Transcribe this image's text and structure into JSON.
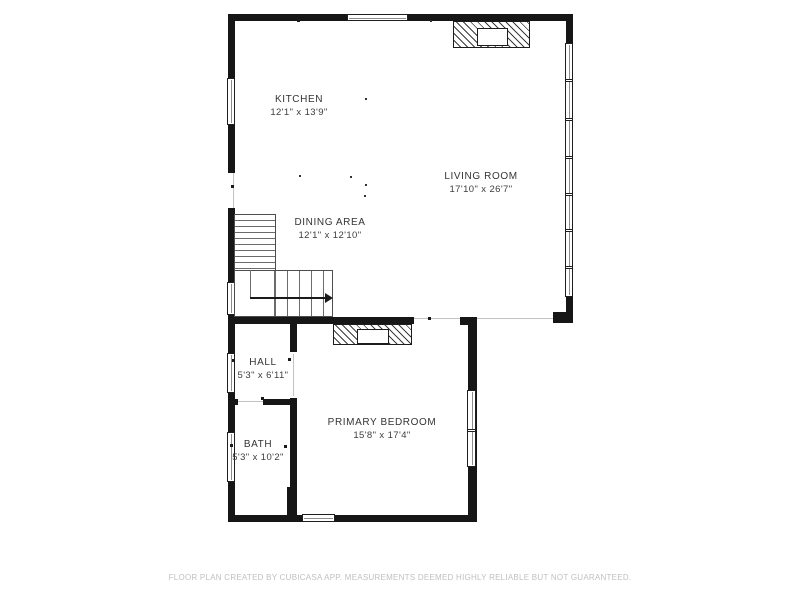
{
  "plan": {
    "type": "floor-plan",
    "source_app": "CubiCasa"
  },
  "rooms": [
    {
      "name": "KITCHEN",
      "dims": "12'1\" x 13'9\""
    },
    {
      "name": "LIVING ROOM",
      "dims": "17'10\" x 26'7\""
    },
    {
      "name": "DINING AREA",
      "dims": "12'1\" x 12'10\""
    },
    {
      "name": "HALL",
      "dims": "5'3\" x 6'11\""
    },
    {
      "name": "BATH",
      "dims": "5'3\" x 10'2\""
    },
    {
      "name": "PRIMARY BEDROOM",
      "dims": "15'8\" x 17'4\""
    }
  ],
  "footer": {
    "disclaimer": "FLOOR PLAN CREATED BY CUBICASA APP. MEASUREMENTS DEEMED HIGHLY RELIABLE BUT NOT GUARANTEED."
  },
  "colors": {
    "background": "#ffffff",
    "wall": "#161616",
    "room_text": "#343434",
    "footer_text": "#c0c0c0"
  }
}
